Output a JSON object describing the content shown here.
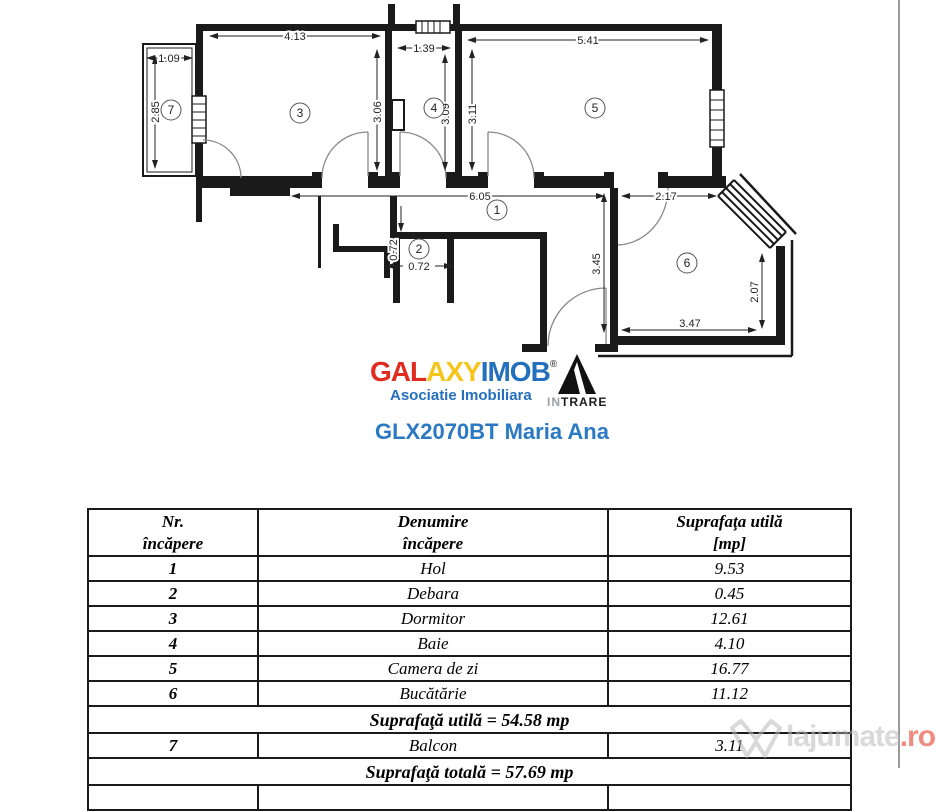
{
  "plan": {
    "dims": {
      "d1_09": "1.09",
      "d2_85": "2.85",
      "d4_13": "4.13",
      "d3_06": "3.06",
      "d1_39": "1.39",
      "d3_09": "3.09",
      "d3_11": "3.11",
      "d5_41": "5.41",
      "d6_05": "6.05",
      "d0_72v": "0.72",
      "d0_72h": "0.72",
      "d2_17": "2.17",
      "d3_45": "3.45",
      "d2_07": "2.07",
      "d3_47": "3.47"
    },
    "rooms": [
      "1",
      "2",
      "3",
      "4",
      "5",
      "6",
      "7"
    ]
  },
  "logo": {
    "gal": "GAL",
    "axy": "AXY",
    "imob": "IMOB",
    "registered": "®",
    "subtitle": "Asociatie Imobiliara",
    "intrare_in": "IN",
    "intrare_trare": "TRARE"
  },
  "title": "GLX2070BT Maria Ana",
  "table": {
    "headers": {
      "nr_line1": "Nr.",
      "nr_line2": "încăpere",
      "den_line1": "Denumire",
      "den_line2": "încăpere",
      "sup_line1": "Suprafaţa utilă",
      "sup_line2": "[mp]"
    },
    "rows": [
      {
        "nr": "1",
        "den": "Hol",
        "mp": "9.53"
      },
      {
        "nr": "2",
        "den": "Debara",
        "mp": "0.45"
      },
      {
        "nr": "3",
        "den": "Dormitor",
        "mp": "12.61"
      },
      {
        "nr": "4",
        "den": "Baie",
        "mp": "4.10"
      },
      {
        "nr": "5",
        "den": "Camera de zi",
        "mp": "16.77"
      },
      {
        "nr": "6",
        "den": "Bucătărie",
        "mp": "11.12"
      }
    ],
    "subtotal": "Suprafaţă utilă  = 54.58 mp",
    "balcony_row": {
      "nr": "7",
      "den": "Balcon",
      "mp": "3.11"
    },
    "total": "Suprafaţă totală = 57.69 mp"
  },
  "watermark": {
    "name": "lajumate",
    "tld": ".ro"
  },
  "colors": {
    "brand_red": "#e02b20",
    "brand_yellow": "#f6c51d",
    "brand_blue": "#2470bd",
    "title_blue": "#2a79c2"
  }
}
